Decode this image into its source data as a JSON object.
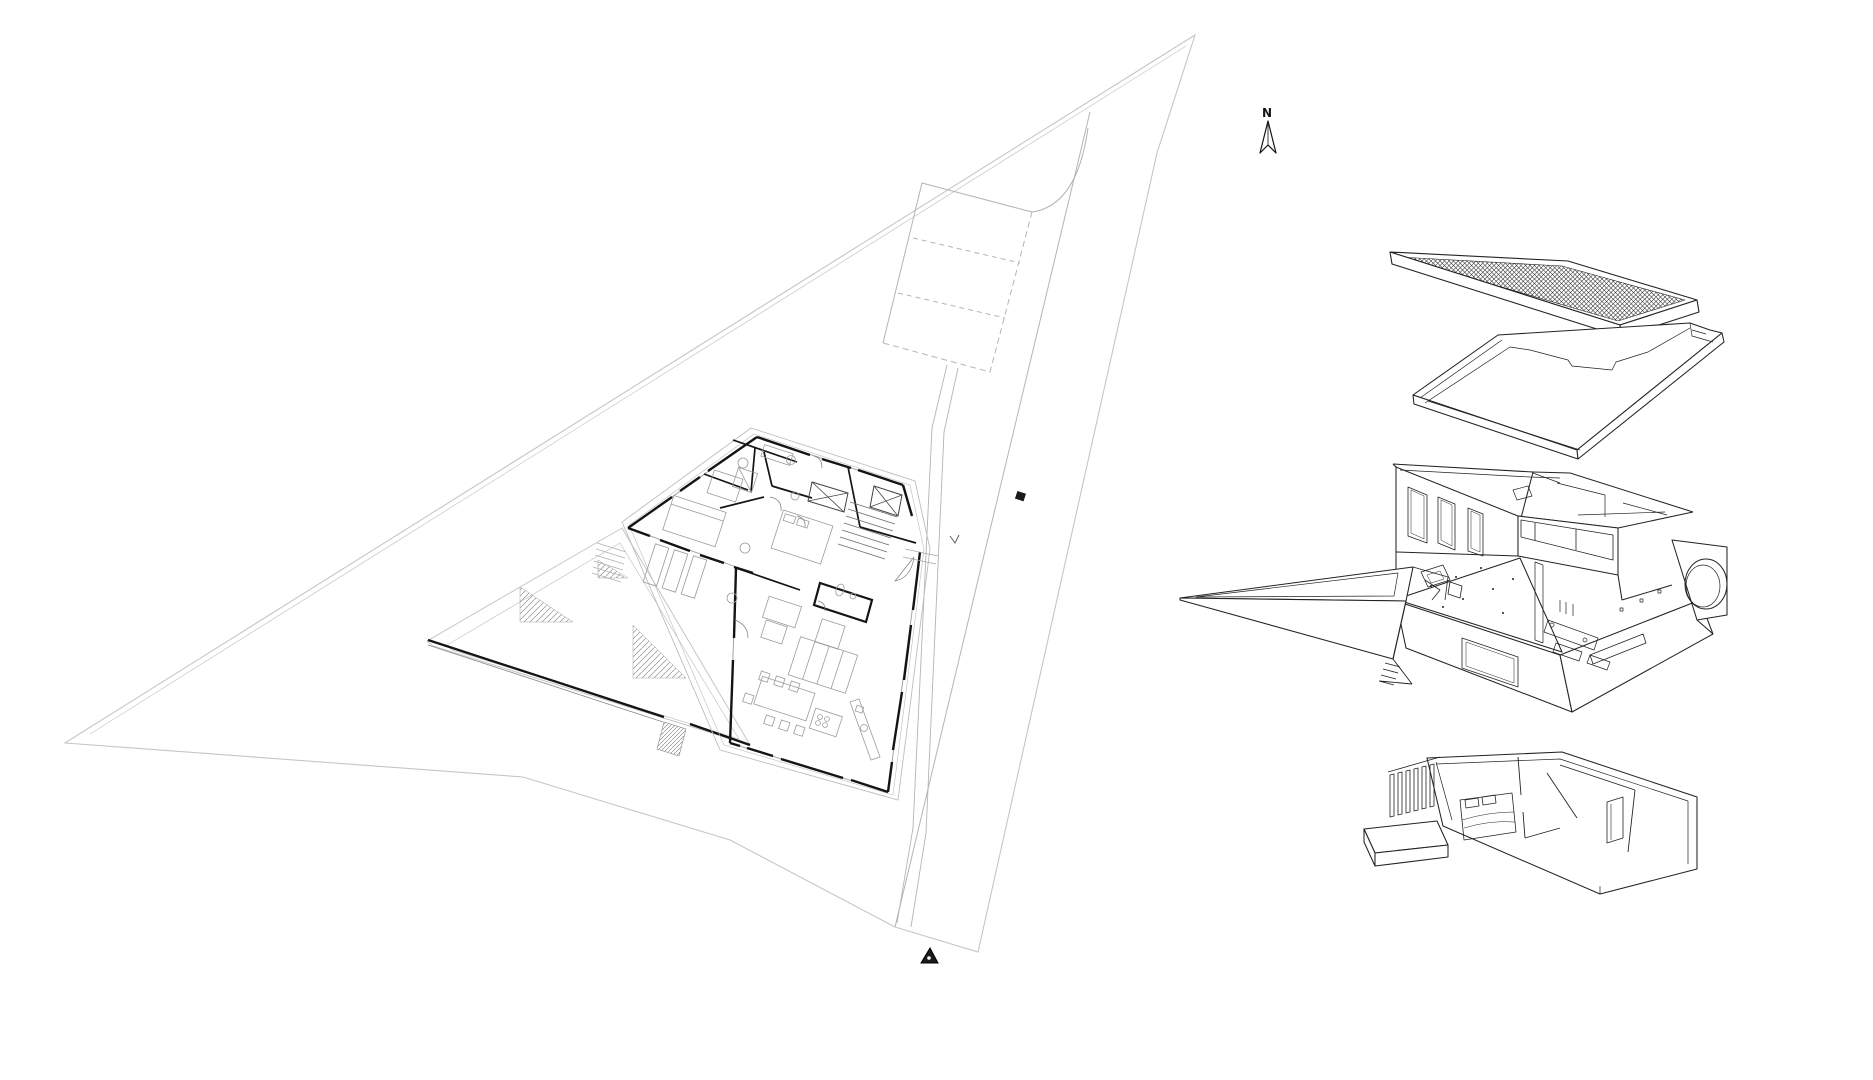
{
  "document": {
    "title": "Architectural site plan with ground-floor plan and exploded axonometric",
    "background": "#ffffff"
  },
  "north_arrow": {
    "label": "N"
  },
  "colors": {
    "background": "#ffffff",
    "wall_ink": "#141414",
    "axon_ink": "#232323",
    "furniture_gray": "#9b9b9b",
    "site_gray": "#c6c6c6",
    "road_gray": "#b4b4b4",
    "hatch_gray": "#8f8f8f",
    "marker_black": "#1b1b1b"
  },
  "site_plan": {
    "label": "site plan",
    "parking_stall_count": 3,
    "features": [
      "site-boundary",
      "access-road",
      "parking-stalls",
      "driveway",
      "garden-terrace",
      "terrace-steps",
      "house-floor-plan",
      "entrance-marker",
      "gate-marker"
    ]
  },
  "axonometric": {
    "label": "exploded axonometric",
    "levels": [
      "roof",
      "roof-slab",
      "upper-level",
      "lower-level"
    ]
  }
}
